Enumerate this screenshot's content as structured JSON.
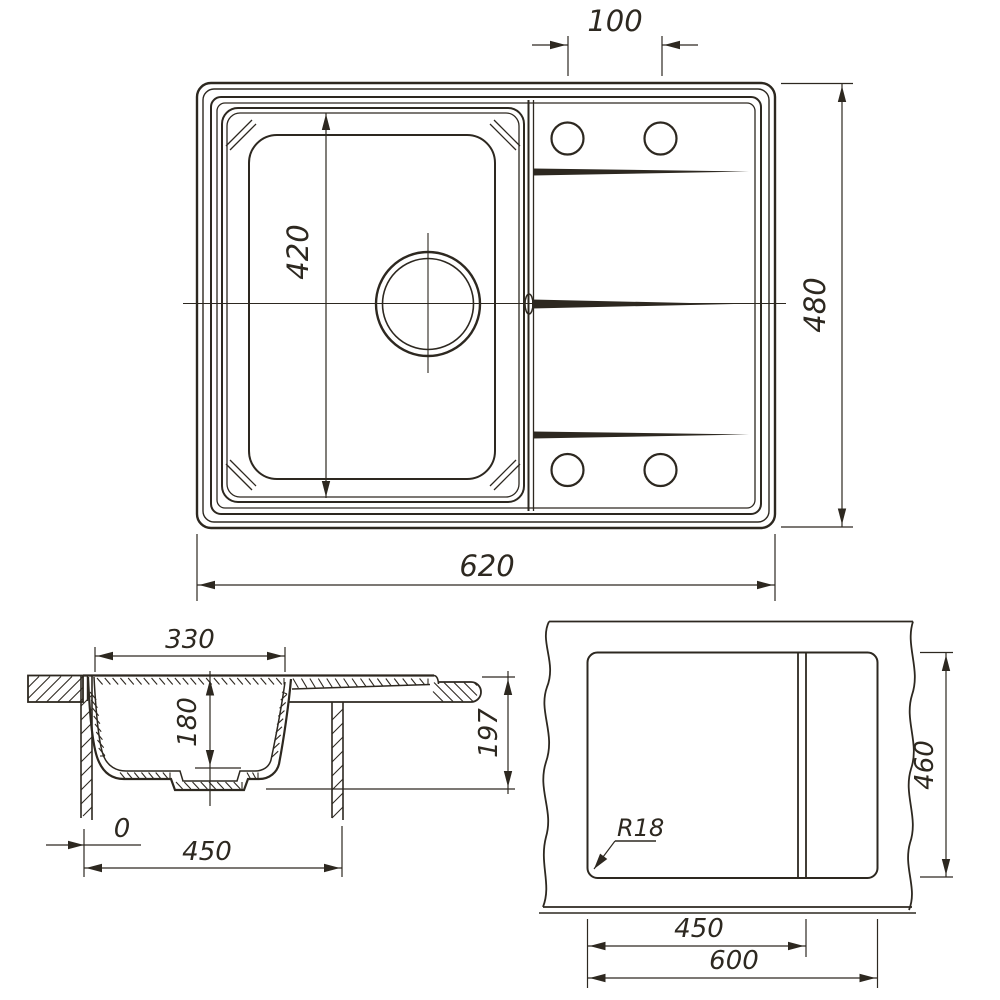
{
  "colors": {
    "line": "#2d2820",
    "background": "#ffffff"
  },
  "views": {
    "top": {
      "overall_width": "620",
      "overall_depth": "480",
      "bowl_length": "420",
      "faucet_hole_spacing": "100"
    },
    "section": {
      "bowl_width": "330",
      "bowl_depth": "180",
      "overall_height": "197",
      "cabinet_width": "450",
      "offset": "0"
    },
    "cutout": {
      "cutout_width": "600",
      "cutout_depth": "460",
      "divider_offset": "450",
      "corner_radius": "R18"
    }
  }
}
